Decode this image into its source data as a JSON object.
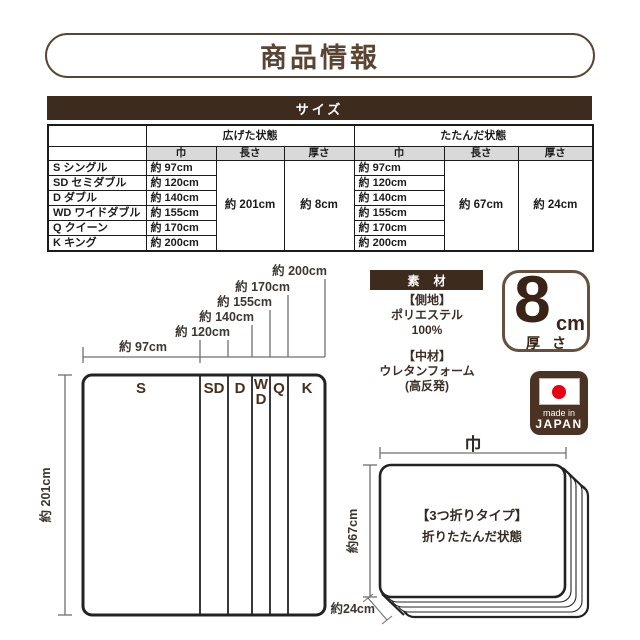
{
  "title": "商品情報",
  "size": {
    "header": "サイズ",
    "table": {
      "col_groups": {
        "open": "広げた状態",
        "folded": "たたんだ状態"
      },
      "dims": {
        "width": "巾",
        "length": "長さ",
        "thickness": "厚さ"
      },
      "rows": [
        {
          "name": "S シングル",
          "open_width": "約 97cm",
          "folded_width": "約 97cm"
        },
        {
          "name": "SD セミダブル",
          "open_width": "約 120cm",
          "folded_width": "約 120cm"
        },
        {
          "name": "D ダブル",
          "open_width": "約 140cm",
          "folded_width": "約 140cm"
        },
        {
          "name": "WD ワイドダブル",
          "open_width": "約 155cm",
          "folded_width": "約 155cm"
        },
        {
          "name": "Q クイーン",
          "open_width": "約 170cm",
          "folded_width": "約 170cm"
        },
        {
          "name": "K キング",
          "open_width": "約 200cm",
          "folded_width": "約 200cm"
        }
      ],
      "merged": {
        "open_length": "約 201cm",
        "open_thickness": "約 8cm",
        "folded_length": "約 67cm",
        "folded_thickness": "約 24cm"
      }
    }
  },
  "open_diagram": {
    "width_labels": [
      "約 97cm",
      "約 120cm",
      "約 140cm",
      "約 155cm",
      "約 170cm",
      "約 200cm"
    ],
    "height_label": "約 201cm",
    "sections": {
      "s": "S",
      "sd": "SD",
      "d": "D",
      "wd_top": "W",
      "wd_bottom": "D",
      "q": "Q",
      "k": "K"
    }
  },
  "material": {
    "header": "素材",
    "cover_label": "【側地】",
    "cover_line1": "ポリエステル",
    "cover_line2": "100%",
    "core_label": "【中材】",
    "core_line1": "ウレタンフォーム",
    "core_line2": "(高反発)"
  },
  "thickness_badge": {
    "value": "8",
    "unit": "cm",
    "caption": "厚さ"
  },
  "origin_badge": {
    "line1": "made in",
    "line2": "JAPAN"
  },
  "folded_diagram": {
    "width_label": "巾",
    "height_label": "約67cm",
    "thickness_label": "約24cm",
    "caption_line1": "【3つ折りタイプ】",
    "caption_line2": "折りたたんだ状態"
  },
  "colors": {
    "primary_dark_brown": "#3D2B1D",
    "title_brown": "#5A4434",
    "accent_brown": "#47301F",
    "flag_red": "#E60012",
    "table_header_gray": "#D9D9D9"
  }
}
